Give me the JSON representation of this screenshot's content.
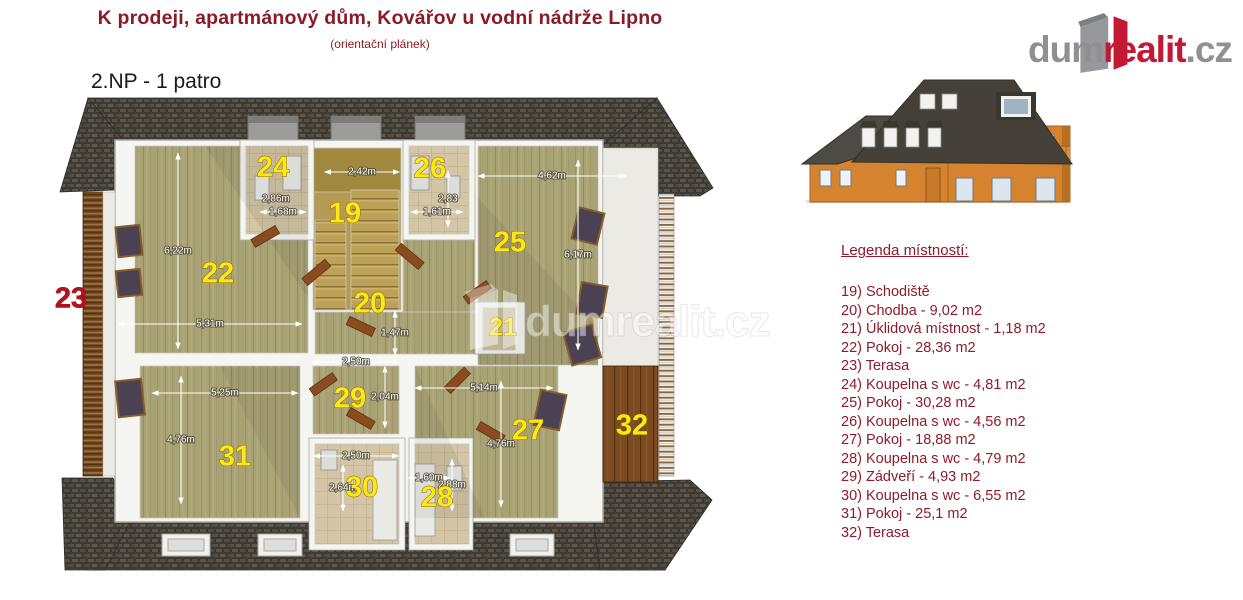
{
  "header": {
    "title": "K prodeji, apartmánový dům, Kovářov u vodní nádrže Lipno",
    "subtitle": "(orientační plánek)",
    "floor_label": "2.NP - 1 patro"
  },
  "logo": {
    "prefix": "dum",
    "highlight": "realit",
    "suffix": ".cz"
  },
  "legend": {
    "heading": "Legenda místností:",
    "items": [
      "19) Schodiště",
      "20) Chodba - 9,02 m2",
      "21) Úklidová místnost - 1,18 m2",
      "22) Pokoj - 28,36 m2",
      "23) Terasa",
      "24) Koupelna s wc - 4,81 m2",
      "25) Pokoj - 30,28 m2",
      "26) Koupelna s wc - 4,56 m2",
      "27) Pokoj - 18,88 m2",
      "28) Koupelna s wc - 4,79 m2",
      "29) Zádveří - 4,93 m2",
      "30) Koupelna s wc - 6,55 m2",
      "31) Pokoj - 25,1 m2",
      "32) Terasa"
    ]
  },
  "floorplan": {
    "watermark_text": "dumrealit.cz",
    "rooms": [
      {
        "n": "19",
        "x": 290,
        "y": 127
      },
      {
        "n": "20",
        "x": 315,
        "y": 217
      },
      {
        "n": "21",
        "x": 448,
        "y": 241,
        "small": true
      },
      {
        "n": "22",
        "x": 163,
        "y": 187
      },
      {
        "n": "23",
        "x": 16,
        "y": 212,
        "red": true
      },
      {
        "n": "24",
        "x": 218,
        "y": 81
      },
      {
        "n": "25",
        "x": 455,
        "y": 156
      },
      {
        "n": "26",
        "x": 375,
        "y": 82
      },
      {
        "n": "27",
        "x": 473,
        "y": 344
      },
      {
        "n": "28",
        "x": 382,
        "y": 411
      },
      {
        "n": "29",
        "x": 295,
        "y": 312
      },
      {
        "n": "30",
        "x": 307,
        "y": 401
      },
      {
        "n": "31",
        "x": 180,
        "y": 370
      },
      {
        "n": "32",
        "x": 577,
        "y": 339
      }
    ],
    "dimensions": [
      {
        "text": "2,42m",
        "x": 307,
        "y": 84,
        "orient": "h",
        "len": 75
      },
      {
        "text": "2,86m",
        "x": 221,
        "y": 111,
        "orient": "h",
        "len": 0
      },
      {
        "text": "1,68m",
        "x": 228,
        "y": 124,
        "orient": "h",
        "len": 46
      },
      {
        "text": "2,83",
        "x": 393,
        "y": 111,
        "orient": "v",
        "len": 56
      },
      {
        "text": "1,61m",
        "x": 382,
        "y": 124,
        "orient": "h",
        "len": 52
      },
      {
        "text": "4,62m",
        "x": 497,
        "y": 88,
        "orient": "h",
        "len": 148
      },
      {
        "text": "6,17m",
        "x": 523,
        "y": 167,
        "orient": "v",
        "len": 190
      },
      {
        "text": "6,22m",
        "x": 123,
        "y": 163,
        "orient": "v",
        "len": 196
      },
      {
        "text": "5,31m",
        "x": 155,
        "y": 236,
        "orient": "h",
        "len": 184
      },
      {
        "text": "1,47m",
        "x": 340,
        "y": 245,
        "orient": "v",
        "len": 44
      },
      {
        "text": "2,50m",
        "x": 301,
        "y": 274,
        "orient": "h",
        "len": 87
      },
      {
        "text": "2,04m",
        "x": 330,
        "y": 309,
        "orient": "v",
        "len": 62
      },
      {
        "text": "5,25m",
        "x": 170,
        "y": 305,
        "orient": "h",
        "len": 146
      },
      {
        "text": "4,76m",
        "x": 126,
        "y": 352,
        "orient": "v",
        "len": 128
      },
      {
        "text": "5,14m",
        "x": 429,
        "y": 300,
        "orient": "h",
        "len": 138
      },
      {
        "text": "4,76m",
        "x": 446,
        "y": 356,
        "orient": "v",
        "len": 126
      },
      {
        "text": "2,50m",
        "x": 301,
        "y": 368,
        "orient": "h",
        "len": 85
      },
      {
        "text": "2,64m",
        "x": 288,
        "y": 400,
        "orient": "v",
        "len": 46
      },
      {
        "text": "1,60m",
        "x": 374,
        "y": 390,
        "orient": "h",
        "len": 42
      },
      {
        "text": "2,88m",
        "x": 397,
        "y": 397,
        "orient": "v",
        "len": 52
      }
    ]
  },
  "colors": {
    "accent_red": "#8a1a28",
    "room_label_yellow": "#ffe614",
    "logo_red": "#c41935",
    "logo_gray": "#909094",
    "roof_gray": "#49453e",
    "floor_olive": "#a9a275",
    "floor_tile": "#d3c5a5",
    "terrace_brown": "#7d4b21"
  }
}
